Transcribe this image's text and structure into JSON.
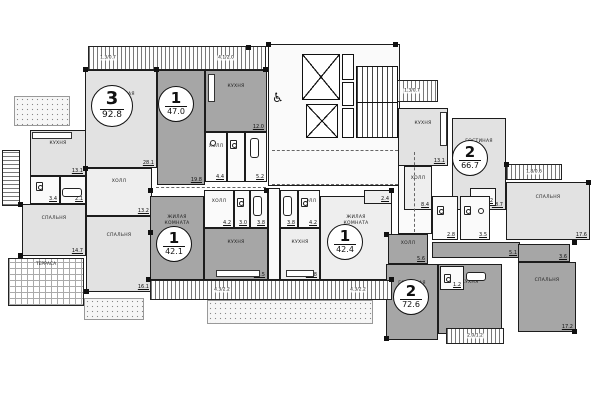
{
  "palette": {
    "wall": "#1c1c1c",
    "bg": "#ffffff",
    "light": "#e2e2e2",
    "lighter": "#eeeeee",
    "dark": "#a6a6a6",
    "white": "#fafafa"
  },
  "apartments": [
    {
      "number": "3",
      "area": "92.8",
      "cx": 112,
      "cy": 106,
      "r": 21
    },
    {
      "number": "1",
      "area": "47.0",
      "cx": 176,
      "cy": 104,
      "r": 18
    },
    {
      "number": "1",
      "area": "42.1",
      "cx": 174,
      "cy": 244,
      "r": 18
    },
    {
      "number": "1",
      "area": "42.4",
      "cx": 345,
      "cy": 242,
      "r": 18
    },
    {
      "number": "2",
      "area": "66.7",
      "cx": 470,
      "cy": 158,
      "r": 18
    },
    {
      "number": "2",
      "area": "72.6",
      "cx": 411,
      "cy": 297,
      "r": 18
    }
  ],
  "rooms": [
    {
      "name": "ГОСТИНАЯ",
      "area": "28.1",
      "x": 85,
      "y": 70,
      "w": 72,
      "h": 98,
      "shade": "light"
    },
    {
      "name": "КУХНЯ",
      "area": "13.1",
      "x": 30,
      "y": 130,
      "w": 56,
      "h": 46,
      "shade": "light"
    },
    {
      "name": "",
      "area": "3.4",
      "x": 30,
      "y": 176,
      "w": 30,
      "h": 28,
      "shade": "white"
    },
    {
      "name": "",
      "area": "2.1",
      "x": 60,
      "y": 176,
      "w": 26,
      "h": 28,
      "shade": "white"
    },
    {
      "name": "СПАЛЬНЯ",
      "area": "14.7",
      "x": 22,
      "y": 204,
      "w": 64,
      "h": 52,
      "shade": "light"
    },
    {
      "name": "ХОЛЛ",
      "area": "13.2",
      "x": 86,
      "y": 168,
      "w": 66,
      "h": 48,
      "shade": "lighter"
    },
    {
      "name": "СПАЛЬНЯ",
      "area": "16.1",
      "x": 86,
      "y": 216,
      "w": 66,
      "h": 76,
      "shade": "light"
    },
    {
      "name": "ЖИЛАЯ\nКОМНАТА",
      "area": "19.8",
      "x": 157,
      "y": 70,
      "w": 48,
      "h": 115,
      "shade": "dark"
    },
    {
      "name": "КУХНЯ",
      "area": "12.0",
      "x": 205,
      "y": 70,
      "w": 62,
      "h": 62,
      "shade": "dark"
    },
    {
      "name": "ХОЛЛ",
      "area": "4.4",
      "x": 205,
      "y": 132,
      "w": 22,
      "h": 50,
      "shade": "white"
    },
    {
      "name": "",
      "area": "",
      "x": 227,
      "y": 132,
      "w": 18,
      "h": 50,
      "shade": "white"
    },
    {
      "name": "",
      "area": "5.2",
      "x": 245,
      "y": 132,
      "w": 22,
      "h": 50,
      "shade": "white"
    },
    {
      "name": "",
      "area": "",
      "x": 268,
      "y": 44,
      "w": 132,
      "h": 142,
      "shade": "white"
    },
    {
      "name": "",
      "area": "",
      "x": 398,
      "y": 148,
      "w": 34,
      "h": 86,
      "shade": "white"
    },
    {
      "name": "ЖИЛАЯ\nКОМНАТА",
      "area": "",
      "x": 150,
      "y": 196,
      "w": 54,
      "h": 84,
      "shade": "dark"
    },
    {
      "name": "ХОЛЛ",
      "area": "4.2",
      "x": 204,
      "y": 190,
      "w": 30,
      "h": 38,
      "shade": "white"
    },
    {
      "name": "",
      "area": "3.0",
      "x": 234,
      "y": 190,
      "w": 16,
      "h": 38,
      "shade": "white"
    },
    {
      "name": "",
      "area": "3.8",
      "x": 250,
      "y": 190,
      "w": 18,
      "h": 38,
      "shade": "white"
    },
    {
      "name": "КУХНЯ",
      "area": "12.5",
      "x": 204,
      "y": 228,
      "w": 64,
      "h": 52,
      "shade": "dark"
    },
    {
      "name": "",
      "area": "",
      "x": 268,
      "y": 188,
      "w": 12,
      "h": 92,
      "shade": "white"
    },
    {
      "name": "",
      "area": "3.8",
      "x": 280,
      "y": 190,
      "w": 18,
      "h": 38,
      "shade": "white"
    },
    {
      "name": "ХОЛЛ",
      "area": "4.2",
      "x": 298,
      "y": 190,
      "w": 22,
      "h": 38,
      "shade": "white"
    },
    {
      "name": "КУХНЯ",
      "area": "12.8",
      "x": 280,
      "y": 228,
      "w": 40,
      "h": 52,
      "shade": "lighter"
    },
    {
      "name": "ЖИЛАЯ\nКОМНАТА",
      "area": "",
      "x": 320,
      "y": 196,
      "w": 72,
      "h": 84,
      "shade": "lighter"
    },
    {
      "name": "",
      "area": "2.4",
      "x": 364,
      "y": 190,
      "w": 28,
      "h": 14,
      "shade": "lighter"
    },
    {
      "name": "КУХНЯ",
      "area": "13.1",
      "x": 398,
      "y": 108,
      "w": 50,
      "h": 58,
      "shade": "light"
    },
    {
      "name": "ГОСТИНАЯ",
      "area": "18.7",
      "x": 452,
      "y": 118,
      "w": 54,
      "h": 92,
      "shade": "light"
    },
    {
      "name": "ХОЛЛ",
      "area": "8.4",
      "x": 404,
      "y": 166,
      "w": 28,
      "h": 44,
      "shade": "lighter"
    },
    {
      "name": "СПАЛЬНЯ",
      "area": "17.6",
      "x": 506,
      "y": 182,
      "w": 84,
      "h": 58,
      "shade": "light"
    },
    {
      "name": "",
      "area": "2.2",
      "x": 470,
      "y": 188,
      "w": 26,
      "h": 18,
      "shade": "white"
    },
    {
      "name": "",
      "area": "2.8",
      "x": 432,
      "y": 196,
      "w": 26,
      "h": 44,
      "shade": "white"
    },
    {
      "name": "",
      "area": "3.5",
      "x": 460,
      "y": 196,
      "w": 30,
      "h": 44,
      "shade": "white"
    },
    {
      "name": "",
      "area": "5.1",
      "x": 432,
      "y": 242,
      "w": 88,
      "h": 16,
      "shade": "dark"
    },
    {
      "name": "ХОЛЛ",
      "area": "5.6",
      "x": 388,
      "y": 234,
      "w": 40,
      "h": 30,
      "shade": "dark"
    },
    {
      "name": "ГОСТИНАЯ",
      "area": "",
      "x": 386,
      "y": 264,
      "w": 52,
      "h": 76,
      "shade": "dark"
    },
    {
      "name": "КУХНЯ",
      "area": "",
      "x": 438,
      "y": 264,
      "w": 64,
      "h": 70,
      "shade": "dark"
    },
    {
      "name": "",
      "area": "1.2",
      "x": 440,
      "y": 266,
      "w": 24,
      "h": 24,
      "shade": "white"
    },
    {
      "name": "",
      "area": "3.6",
      "x": 518,
      "y": 244,
      "w": 52,
      "h": 18,
      "shade": "dark"
    },
    {
      "name": "СПАЛЬНЯ",
      "area": "17.2",
      "x": 518,
      "y": 262,
      "w": 58,
      "h": 70,
      "shade": "dark"
    }
  ],
  "hatches": [
    {
      "x": 88,
      "y": 46,
      "w": 178,
      "h": 24,
      "dir": "v"
    },
    {
      "x": 386,
      "y": 80,
      "w": 52,
      "h": 22,
      "dir": "v"
    },
    {
      "x": 150,
      "y": 280,
      "w": 242,
      "h": 20,
      "dir": "v"
    },
    {
      "x": 506,
      "y": 164,
      "w": 56,
      "h": 16,
      "dir": "v"
    },
    {
      "x": 446,
      "y": 328,
      "w": 58,
      "h": 16,
      "dir": "v"
    },
    {
      "x": 2,
      "y": 150,
      "w": 18,
      "h": 56,
      "dir": "h"
    }
  ],
  "dims": [
    {
      "text": "1.3/0.7",
      "x": 108,
      "y": 58
    },
    {
      "text": "4.1/2.0",
      "x": 226,
      "y": 58
    },
    {
      "text": "1.3/0.7",
      "x": 412,
      "y": 91
    },
    {
      "text": "4.3/2.2",
      "x": 222,
      "y": 290
    },
    {
      "text": "4.3/2.2",
      "x": 358,
      "y": 290
    },
    {
      "text": "1.8/0.6",
      "x": 534,
      "y": 172
    },
    {
      "text": "2.0/1.2",
      "x": 475,
      "y": 336
    }
  ],
  "terrace": {
    "label": "ТЕРРАСА",
    "x": 8,
    "y": 258,
    "w": 76,
    "h": 48
  },
  "stipples": [
    [
      14,
      96,
      56,
      30
    ],
    [
      84,
      298,
      60,
      22
    ],
    [
      207,
      300,
      166,
      24
    ]
  ],
  "core": {
    "elevators": [
      [
        302,
        54,
        38,
        46
      ],
      [
        306,
        104,
        32,
        34
      ]
    ],
    "cells": [
      [
        342,
        54,
        12,
        26
      ],
      [
        342,
        82,
        12,
        24
      ],
      [
        342,
        108,
        12,
        30
      ]
    ],
    "stairs": [
      356,
      66,
      42,
      72
    ],
    "wheelchair_icon": "♿",
    "wheelchair": [
      272,
      92
    ]
  },
  "columns": [
    [
      83,
      67
    ],
    [
      154,
      67
    ],
    [
      263,
      67
    ],
    [
      266,
      42
    ],
    [
      393,
      42
    ],
    [
      83,
      166
    ],
    [
      148,
      188
    ],
    [
      264,
      188
    ],
    [
      389,
      188
    ],
    [
      146,
      277
    ],
    [
      389,
      277
    ],
    [
      18,
      202
    ],
    [
      18,
      253
    ],
    [
      84,
      289
    ],
    [
      384,
      232
    ],
    [
      384,
      336
    ],
    [
      572,
      240
    ],
    [
      572,
      329
    ],
    [
      586,
      180
    ],
    [
      504,
      162
    ],
    [
      246,
      45
    ],
    [
      148,
      230
    ]
  ],
  "dashes": [
    {
      "x": 272,
      "y": 150,
      "w": 126,
      "h": 0
    },
    {
      "x": 272,
      "y": 184,
      "w": 126,
      "h": 0
    },
    {
      "x": 156,
      "y": 187,
      "w": 110,
      "h": 0
    },
    {
      "x": 414,
      "y": 152,
      "w": 0,
      "h": 80
    }
  ],
  "counters": [
    [
      216,
      270,
      44,
      7
    ],
    [
      286,
      270,
      28,
      7
    ],
    [
      32,
      132,
      40,
      7
    ],
    [
      208,
      74,
      7,
      28
    ],
    [
      440,
      112,
      7,
      34
    ]
  ],
  "fixtures": [
    {
      "type": "toilet",
      "x": 36,
      "y": 182
    },
    {
      "type": "tub_h",
      "x": 62,
      "y": 188
    },
    {
      "type": "sink",
      "x": 210,
      "y": 140
    },
    {
      "type": "toilet",
      "x": 230,
      "y": 140
    },
    {
      "type": "tub_v",
      "x": 250,
      "y": 138
    },
    {
      "type": "toilet",
      "x": 237,
      "y": 198
    },
    {
      "type": "tub_v",
      "x": 253,
      "y": 196
    },
    {
      "type": "tub_v",
      "x": 283,
      "y": 196
    },
    {
      "type": "toilet",
      "x": 301,
      "y": 198
    },
    {
      "type": "toilet",
      "x": 437,
      "y": 206
    },
    {
      "type": "toilet",
      "x": 464,
      "y": 206
    },
    {
      "type": "sink",
      "x": 478,
      "y": 208
    },
    {
      "type": "toilet",
      "x": 444,
      "y": 274
    },
    {
      "type": "tub_h",
      "x": 466,
      "y": 272
    }
  ]
}
